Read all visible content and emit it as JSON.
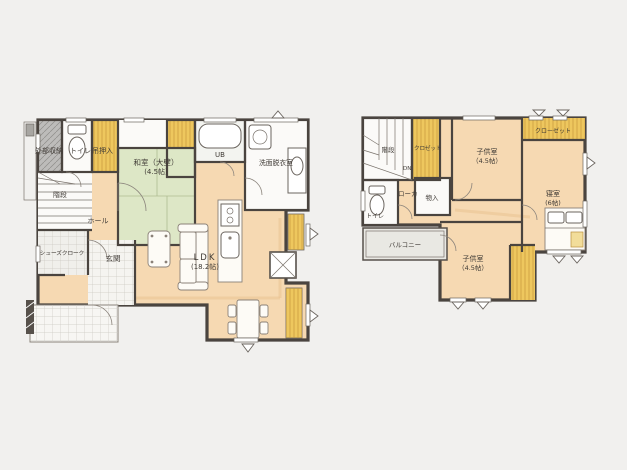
{
  "floor1": {
    "ext_storage": "外部収納",
    "toilet": "トイレ",
    "hanging_closet": "吊押入",
    "washitsu": {
      "line1": "和室（大壁）",
      "line2": "(4.5帖)"
    },
    "ub": "UB",
    "washroom": "洗面脱衣室",
    "stairs": "階段",
    "hall": "ホール",
    "shoes_closet": "シューズクローク",
    "entrance": "玄関",
    "ldk": {
      "line1": "LDK",
      "line2": "(18.2帖)"
    }
  },
  "floor2": {
    "stairs": "階段",
    "down": "DN",
    "closet": "クロゼット",
    "toilet": "トイレ",
    "corridor": "ローカ",
    "storage": "物入",
    "kids_room_a": {
      "line1": "子供室",
      "line2": "（4.5帖）"
    },
    "closet_main": "クローゼット",
    "bedroom": {
      "line1": "寝室",
      "line2": "(6帖)"
    },
    "kids_room_b": {
      "line1": "子供室",
      "line2": "（4.5帖）"
    },
    "balcony": "バルコニー"
  },
  "colors": {
    "wall": "#4a443f",
    "floor_wood": "#f6d9b2",
    "tatami": "#dde7c6",
    "closet_yellow": "#eec75e",
    "storage_gray": "#bdbcba",
    "balcony_gray": "#e9e8e3",
    "background": "#f1f0ee"
  }
}
